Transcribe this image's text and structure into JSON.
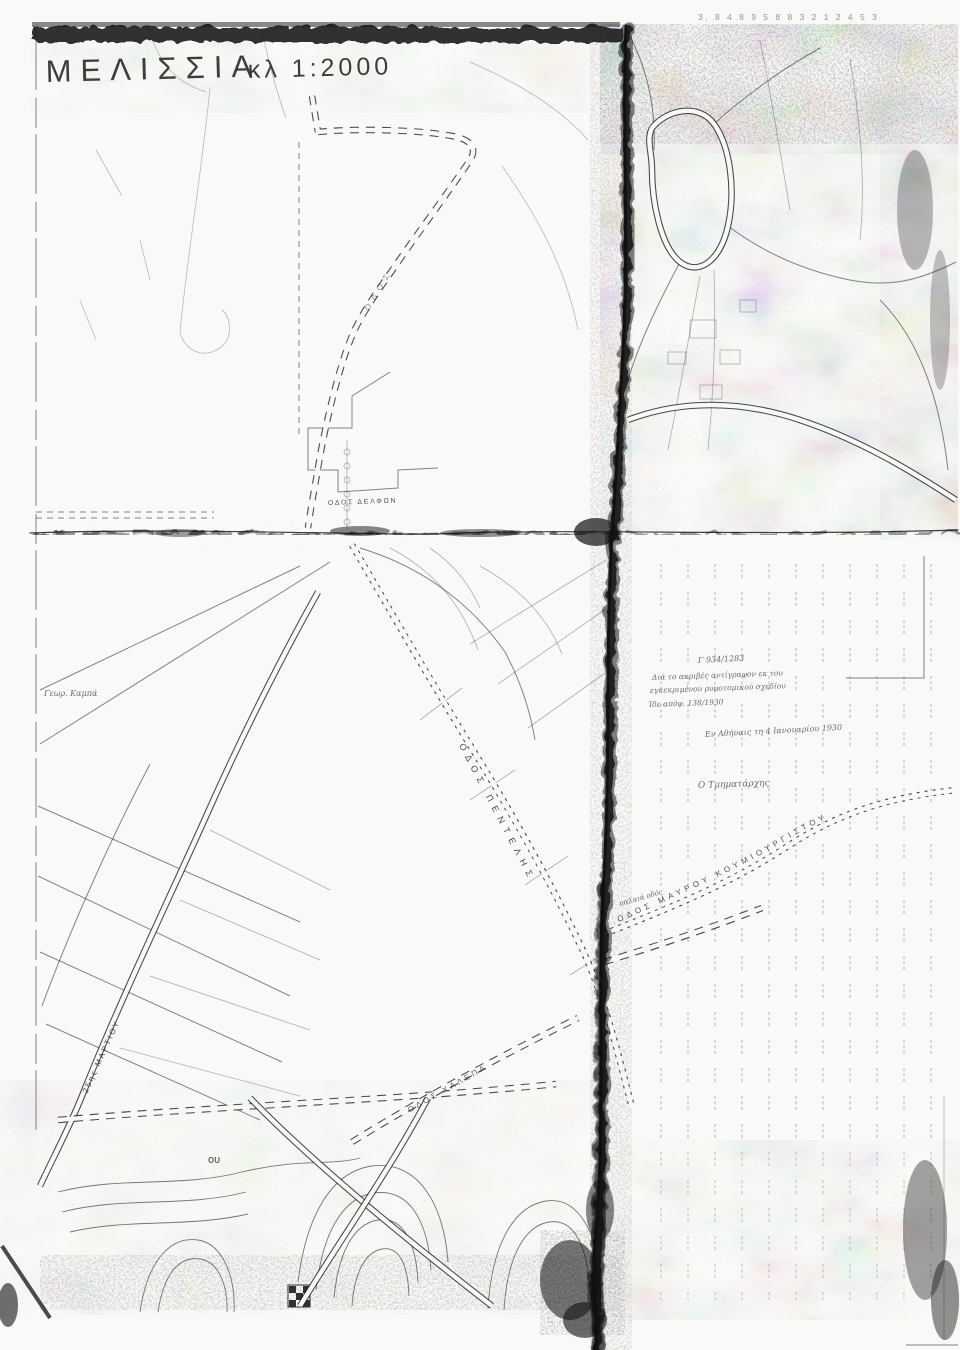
{
  "header": {
    "title": "ΜΕΛΙΣΣΙΑ",
    "scale": "κλ 1:2000",
    "corner_marks": "3.  8 4 8 9 5 8 8 3 2 1 2  4 5 3"
  },
  "roads": {
    "pentelis": "ΟΔΟΣ ΠΕΝΤΕΛΗΣ",
    "mavrou": "ΟΔΟΣ ΜΑΥΡΟΥ ΚΟΥΜΙΟΥΡΓΙΣΤΟΥ",
    "palaia": "παλαιά οδός",
    "delfon": "ΟΔΟΣ ΔΕΛΦΩΝ",
    "martiou": "25ης ΜΑΡΤΙΟΥ",
    "halepa": "ΟΔΟΣ ΧΑΛΕΠΑ",
    "upper": "ΟΔΟΣ"
  },
  "annotations": {
    "ref": "Γ 934/1283",
    "line1": "Διά το ακριβές αντίγραφον εκ του",
    "line2": "εγκεκριμένου ρυμοτομικού σχεδίου",
    "line3": "Ίδε απόφ. 138/1930",
    "date": "Εν Αθήναις τη 4 Ιανουαρίου 1930",
    "signature": "Ο Τμηματάρχης",
    "estate": "Γεωρ. Καμπά",
    "fragment": "ου"
  }
}
